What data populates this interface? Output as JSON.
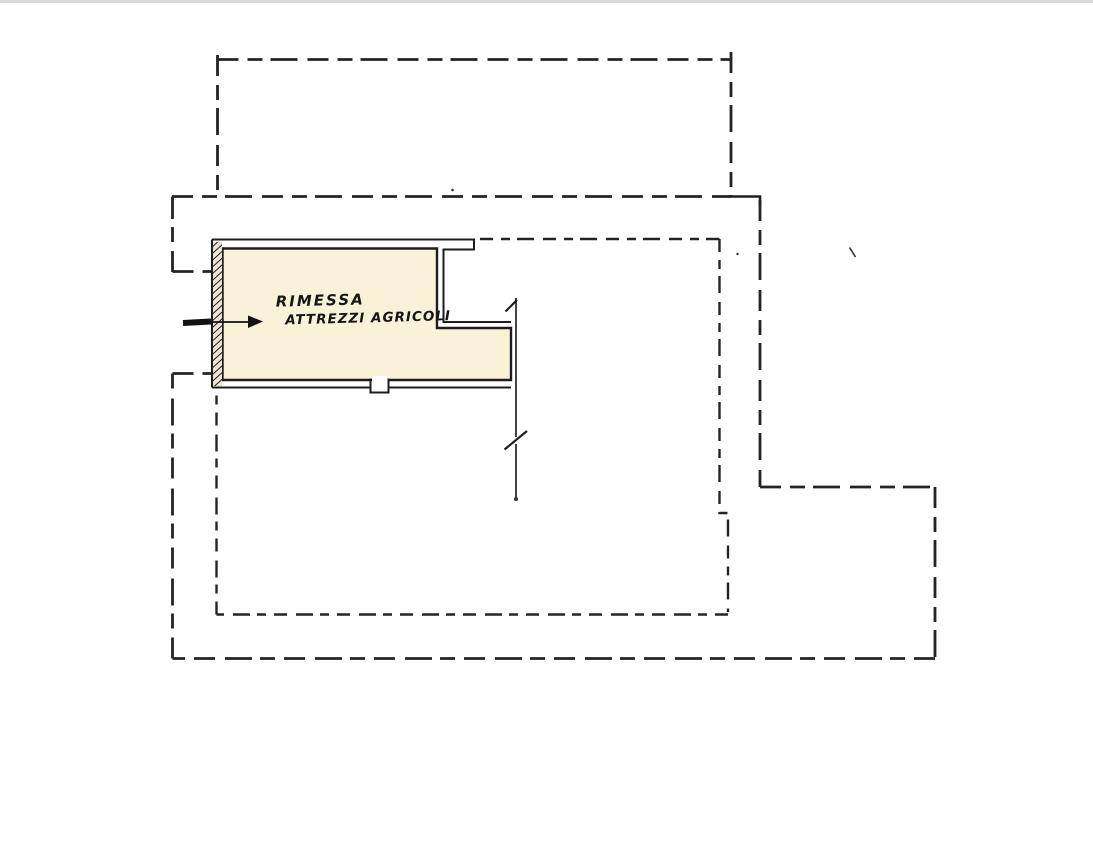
{
  "page": {
    "background_color": "#ffffff",
    "top_edge_color": "#dadada"
  },
  "colors": {
    "ink": "#242424",
    "building_fill": "#f7f2d8"
  },
  "plan": {
    "label_line1": "RIMESSA",
    "label_line2": "ATTREZZI AGRICOLI"
  }
}
